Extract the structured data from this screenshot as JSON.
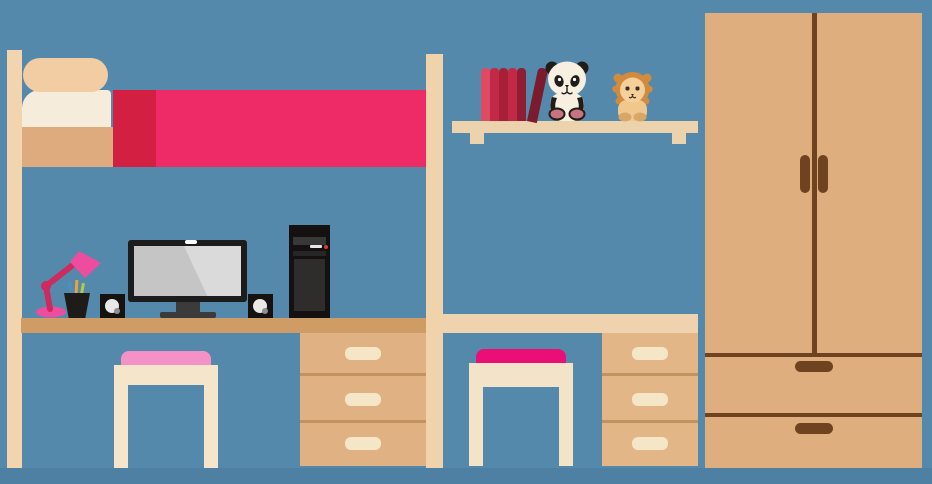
{
  "scene": {
    "type": "flat vector illustration",
    "subject": "children's bedroom with loft bed over a computer desk, second desk below a wall shelf holding books and plush toys, two stools with drawer units, and a wardrobe",
    "objects": [
      "loft-bed",
      "pillows",
      "mattress",
      "blanket",
      "bed-posts",
      "desk-left",
      "desk-right",
      "drawer-unit-left",
      "drawer-unit-right",
      "stool-left",
      "stool-right",
      "desk-lamp",
      "pencil-cup",
      "pencils",
      "speaker-left",
      "speaker-right",
      "monitor",
      "monitor-stand",
      "pc-tower",
      "wall-shelf",
      "shelf-brackets",
      "books",
      "leaning-book",
      "panda-plush",
      "lion-plush",
      "wardrobe",
      "wardrobe-doors",
      "wardrobe-handles",
      "wardrobe-drawers",
      "floor"
    ],
    "counts": {
      "upright_books": 5,
      "leaning_books": 1,
      "drawers_per_desk_unit": 3,
      "wardrobe_drawers": 2,
      "stools": 2,
      "speakers": 2
    }
  },
  "palette": {
    "background_blue": "#5589ac",
    "floor_blue": "#4d80a3",
    "wood_cream": "#f0d3ab",
    "wood_tan": "#ddab7d",
    "desk_left_tan": "#d09c66",
    "desk_right_cream": "#eed3ae",
    "drawer_tan": "#dfb183",
    "drawer_pull_cream": "#f5e6c8",
    "blanket_pink": "#ee2a67",
    "blanket_edge_red": "#d31f42",
    "pillow_peach": "#f2cda3",
    "pillow_cream": "#f6ecdb",
    "stool_cushion_light_pink": "#f492c8",
    "stool_cushion_magenta": "#ea0e77",
    "lamp_pink": "#ec4d9e",
    "lamp_arm_dark_pink": "#ce2a60",
    "electronics_black": "#1c1c1c",
    "screen_gray": "#c5c5c5",
    "tower_led_red": "#d83a3a",
    "book_reds": [
      "#df4a63",
      "#c32946",
      "#a81f38",
      "#c32946",
      "#8f1d33",
      "#7c1b2d"
    ],
    "wardrobe_tan": "#dfae7e",
    "wardrobe_brown": "#6f431f",
    "panda_cream": "#f7efe0",
    "panda_black": "#201c19",
    "panda_paw_rose": "#c97380",
    "lion_mane_orange": "#d28a3c",
    "lion_face_tan": "#f5d09a",
    "lion_body_tan": "#f0c78d",
    "lion_paw_tan": "#d8a765"
  }
}
